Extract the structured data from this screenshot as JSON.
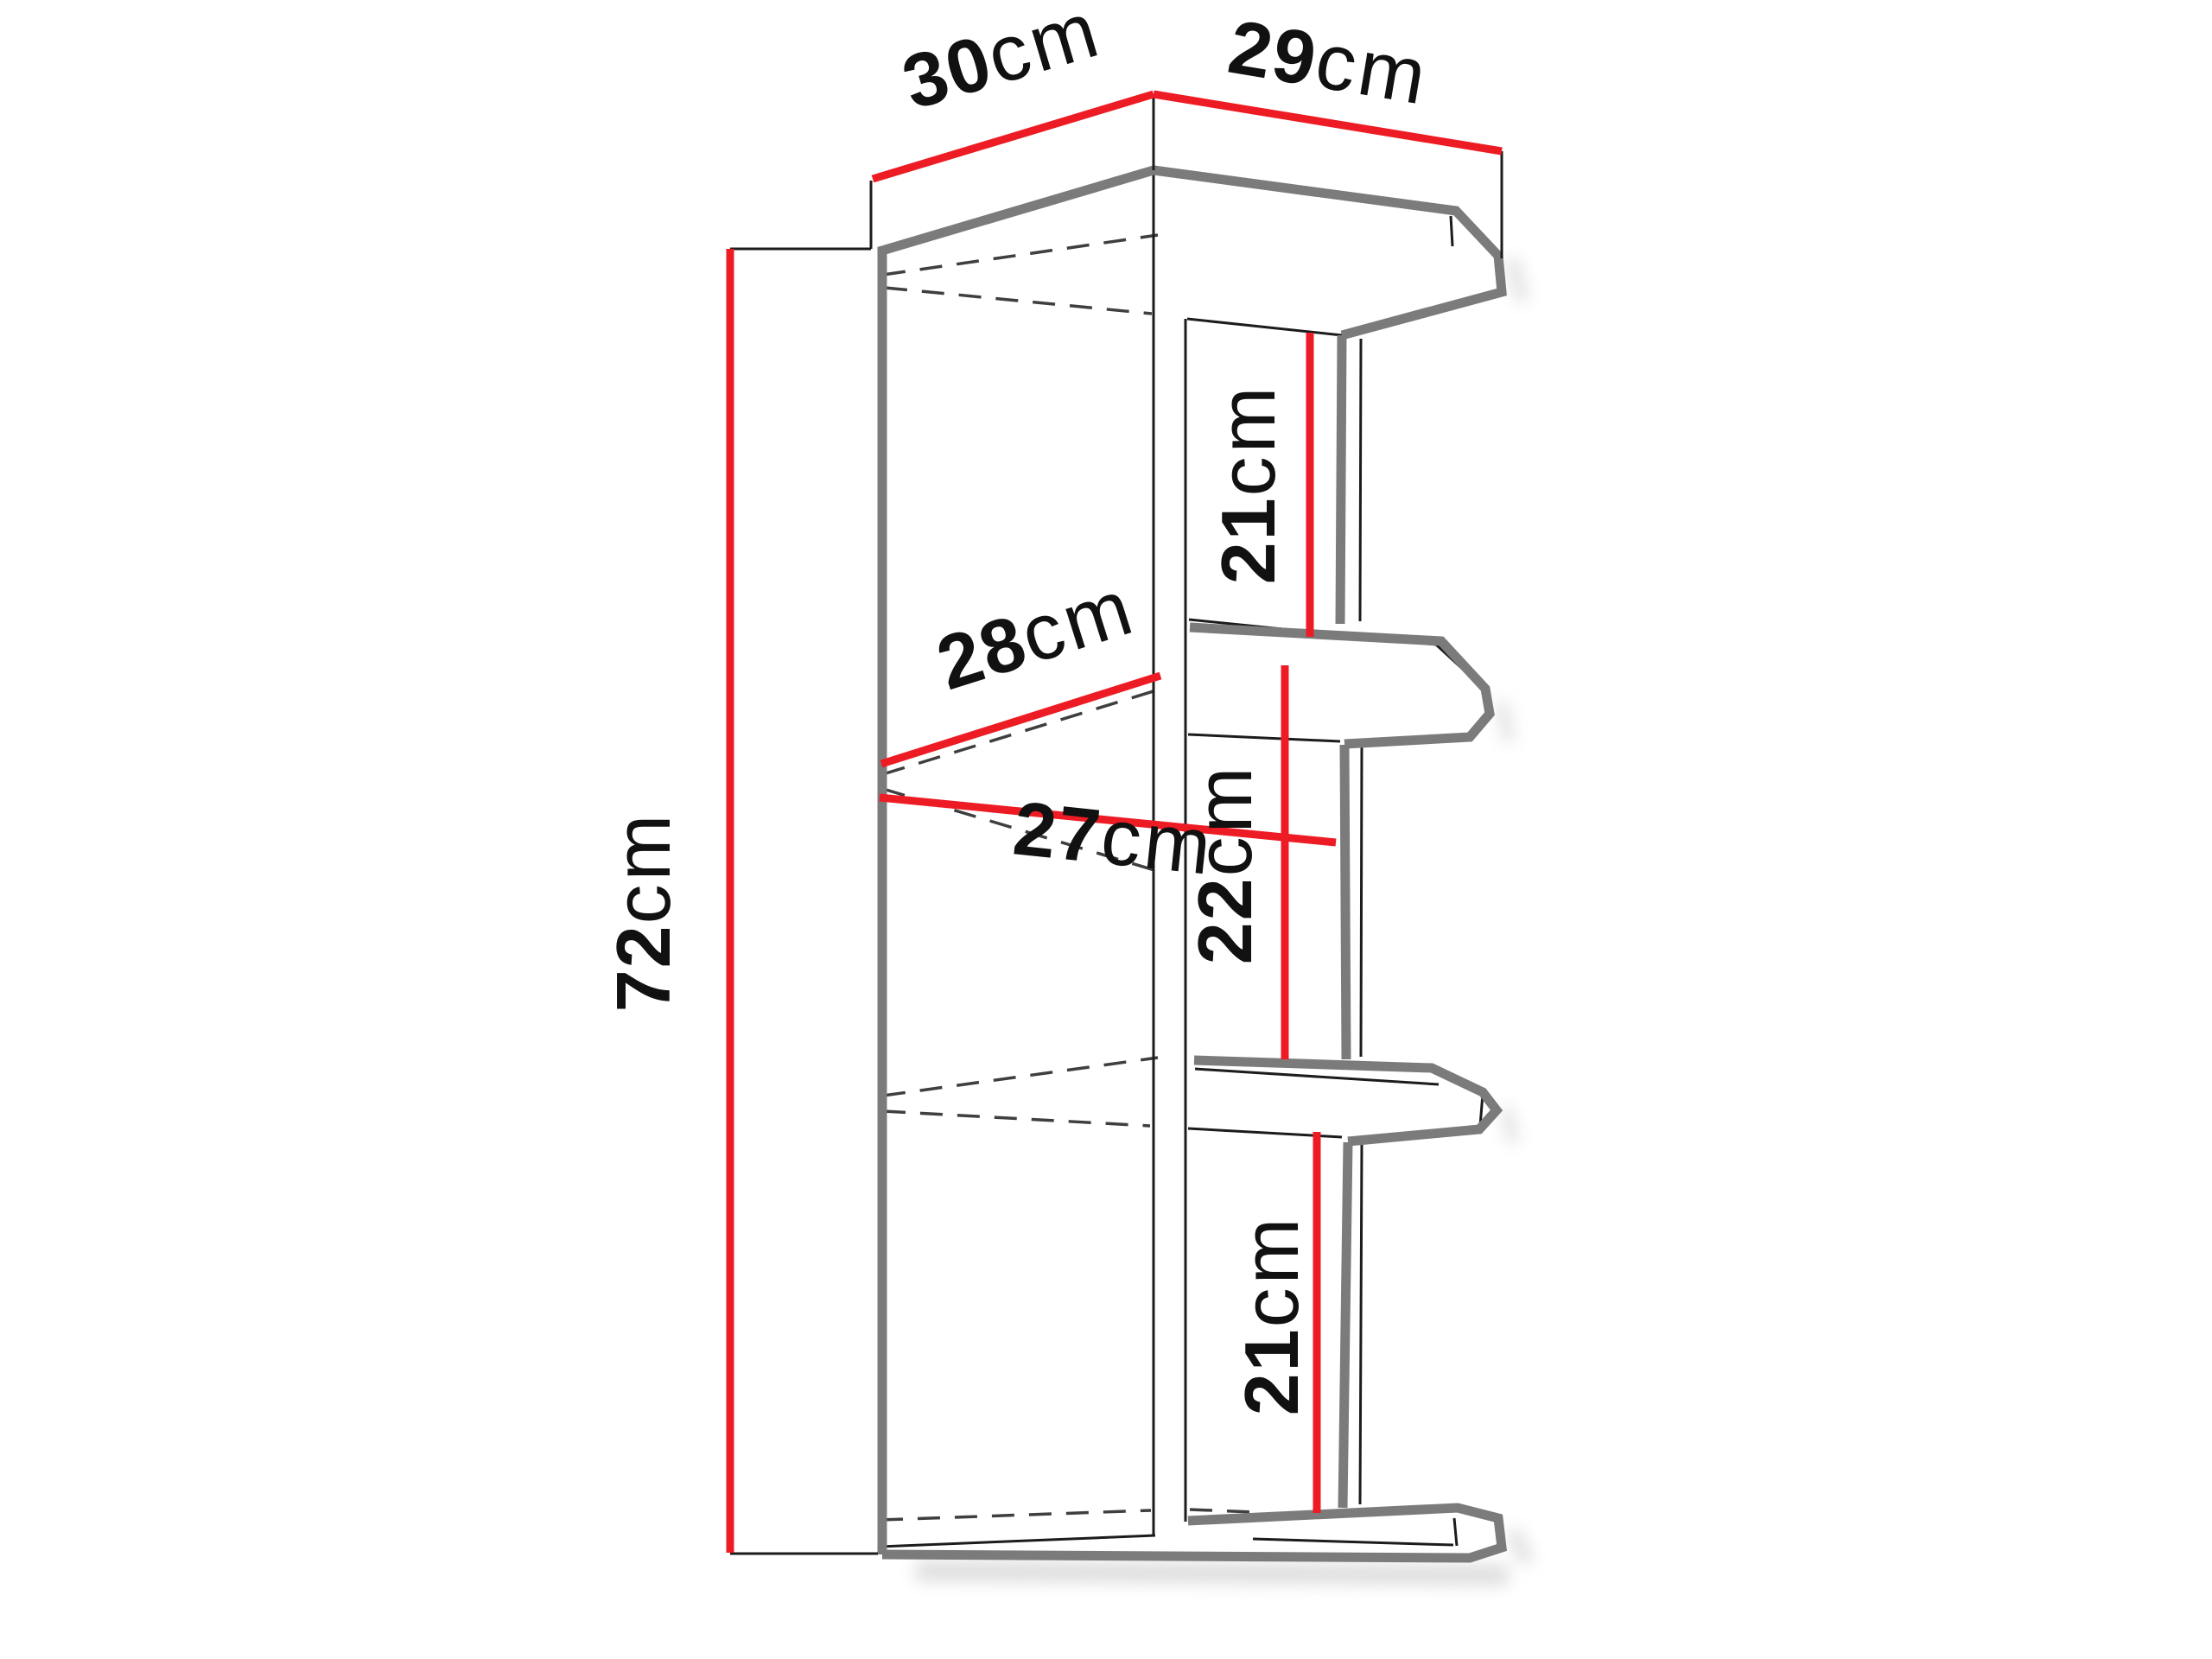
{
  "diagram": {
    "type": "furniture-dimension-diagram",
    "subject": "corner wall shelf unit with three open compartments and chamfered shelf fronts",
    "labels": {
      "depth_left": {
        "value": "30",
        "unit": "cm"
      },
      "width_right": {
        "value": "29",
        "unit": "cm"
      },
      "total_height": {
        "value": "72",
        "unit": "cm"
      },
      "inner_depth_upper": {
        "value": "28",
        "unit": "cm"
      },
      "inner_depth_lower": {
        "value": "27",
        "unit": "cm"
      },
      "compartment_top": {
        "value": "21",
        "unit": "cm"
      },
      "compartment_middle": {
        "value": "22",
        "unit": "cm"
      },
      "compartment_bottom": {
        "value": "21",
        "unit": "cm"
      }
    },
    "colors": {
      "dimension_red": "#ed1c24",
      "outline_gray": "#7b7b7b",
      "line_black": "#1c1c1c",
      "dashed_gray": "#3f3f3f",
      "shadow_gray": "#9a9a9a",
      "text_black": "#111111",
      "background": "#ffffff"
    }
  }
}
